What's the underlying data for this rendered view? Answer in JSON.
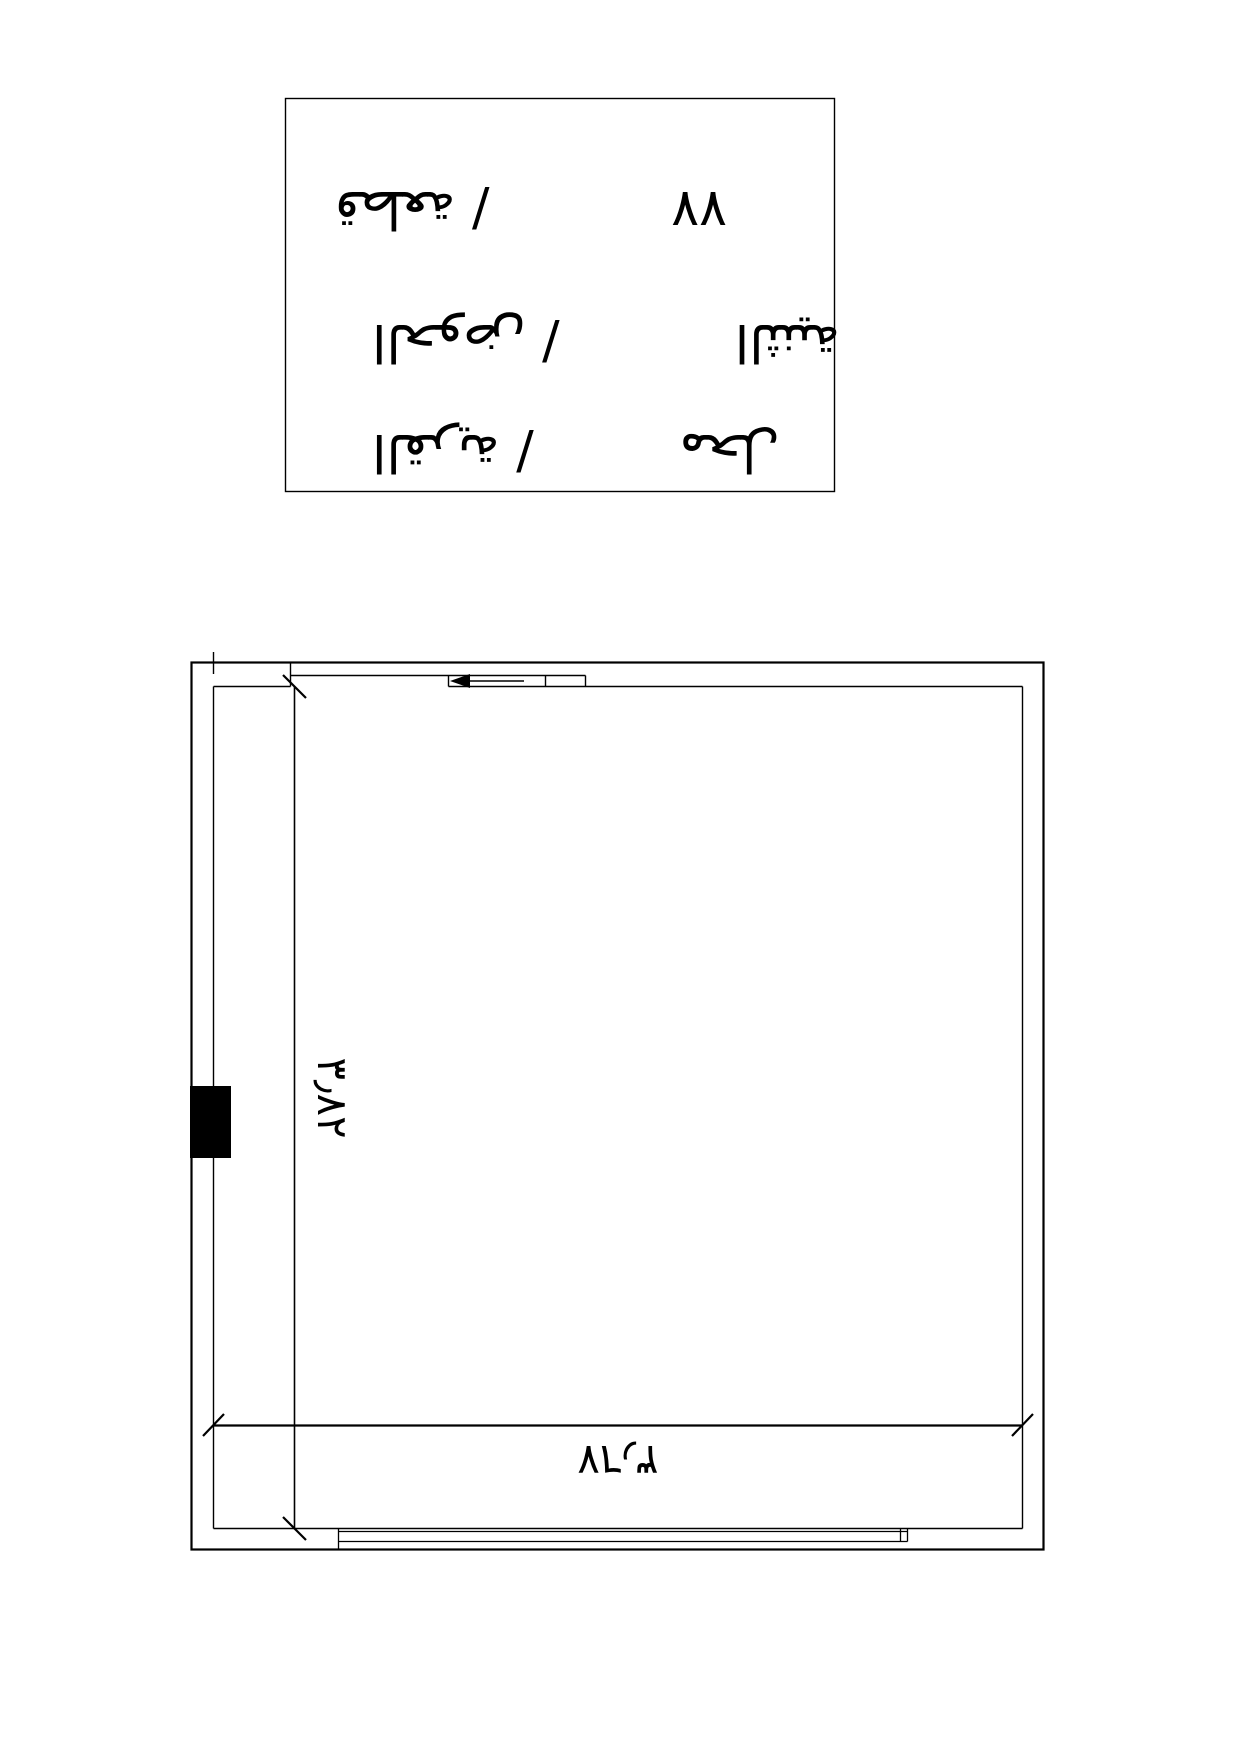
{
  "document": {
    "background": "#ffffff",
    "ink": "#000000",
    "text_orientation": "rotated-180"
  },
  "title_block": {
    "rows": [
      {
        "label": "قطعة /",
        "value": "٧٧"
      },
      {
        "label": "الحوض /",
        "value": "الثنية"
      },
      {
        "label": "القرية /",
        "value": "محل"
      }
    ]
  },
  "floor_plan": {
    "dimensions": {
      "horizontal_label": "٣٫٦٧",
      "vertical_label": "٣٫٨٢"
    },
    "features": {
      "sliding_door_arrow_direction": "left",
      "wall_marker": "filled-rectangle"
    }
  }
}
